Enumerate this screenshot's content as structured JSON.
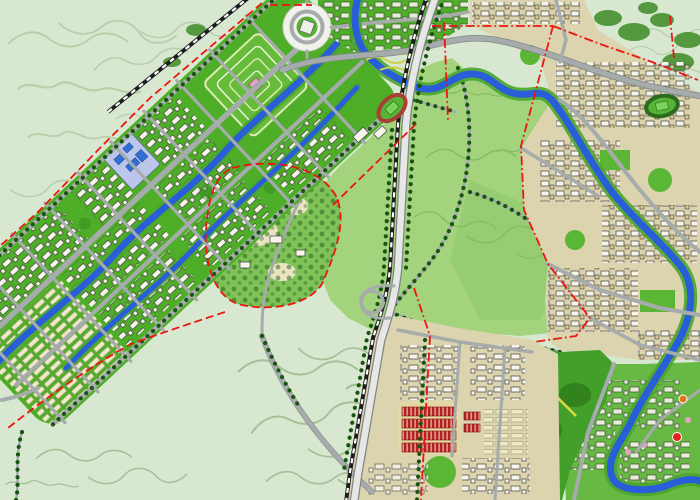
{
  "map": {
    "kind": "urban-masterplan-map",
    "regions": [
      "terrain",
      "new-town-corridor",
      "central-park",
      "hill-campus",
      "forest-park",
      "east-city",
      "southeast-district",
      "green-urban-district"
    ],
    "water_features": [
      "main-river",
      "corridor-canal-upper",
      "corridor-canal-lower"
    ],
    "transport": [
      "railway-northwest",
      "railway-central",
      "central-highway",
      "loop-interchange",
      "circular-plaza",
      "tree-lined-boulevards"
    ],
    "landmarks": [
      "red-track-stadium",
      "east-stadium",
      "formal-garden-axis",
      "red-row-buildings",
      "lavender-block",
      "yellow-ropeway"
    ],
    "boundary_style": "red-dashed-line",
    "markers": [
      {
        "name": "orange-dot",
        "color": "#e0761c"
      },
      {
        "name": "red-dot",
        "color": "#e8221a"
      }
    ]
  },
  "palette": {
    "terrain": "#d8e8d0",
    "contour": "#b7d0ab",
    "contourDark": "#a6c099",
    "parkGreen": "#a3d37d",
    "parkContour": "#88bd62",
    "corridorGreen": "#4fae28",
    "forest": "#419f2a",
    "forestDark": "#2e7a1a",
    "greenUrban": "#67b943",
    "treeDot": "#1a5411",
    "water": "#2a5ed8",
    "bank": "#4aa52e",
    "road": "#a6abac",
    "roadCasing": "#808687",
    "highway": "#e7e8e6",
    "cityGround": "#dcd4ae",
    "cityBldg": "#f7f4e9",
    "tanBldg": "#d9c892",
    "rowBldg": "#efe9c6",
    "bldgStroke": "#3f3f3f",
    "redBldg": "#b2231b",
    "boundary": "#ee1510",
    "railway": "#1d1d1d",
    "stadiumTrack": "#a84035",
    "stadiumField": "#56b336",
    "plaza": "#f1f2ec",
    "pathTan": "#c9b989",
    "yellowLine": "#dedb42",
    "lavender": "#bcc6ea",
    "blueBldg": "#2f6fd6",
    "pink": "#e3a3c6",
    "orange": "#e0761c",
    "markerRed": "#e8221a"
  }
}
